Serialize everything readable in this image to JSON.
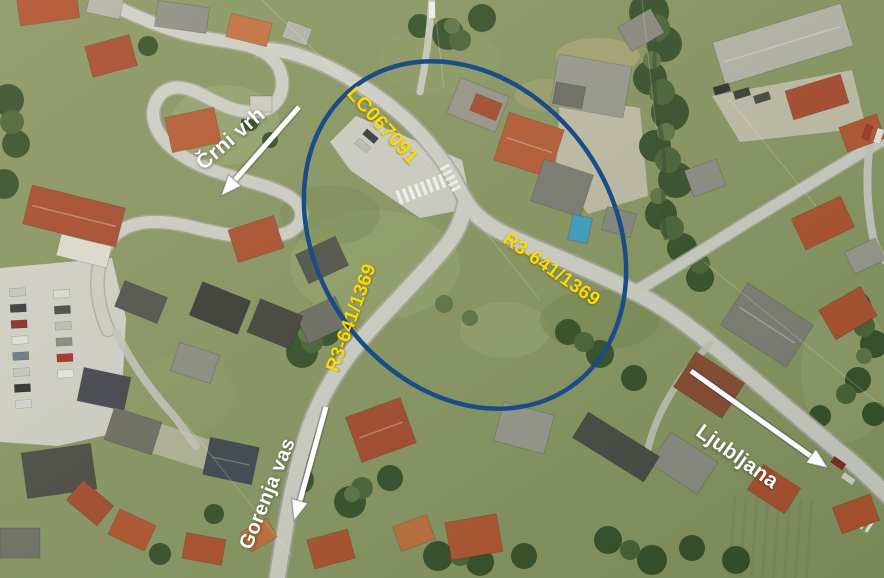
{
  "map": {
    "highlight_ellipse": {
      "color": "#1a4c85"
    },
    "road_labels": [
      {
        "id": "lc067091",
        "text": "LC067091"
      },
      {
        "id": "r3-641-1369-east",
        "text": "R3-641/1369"
      },
      {
        "id": "r3-641-1369-south",
        "text": "R3-641/1369"
      }
    ],
    "direction_labels": [
      {
        "id": "crni-vrh",
        "text": "Črni vrh"
      },
      {
        "id": "gorenja-vas",
        "text": "Gorenja vas"
      },
      {
        "id": "ljubljana",
        "text": "Ljubljana"
      }
    ],
    "colors": {
      "road_label": "#ffd900",
      "direction_label": "#ffffff",
      "highlight": "#1a4c85",
      "arrow": "#ffffff"
    }
  }
}
